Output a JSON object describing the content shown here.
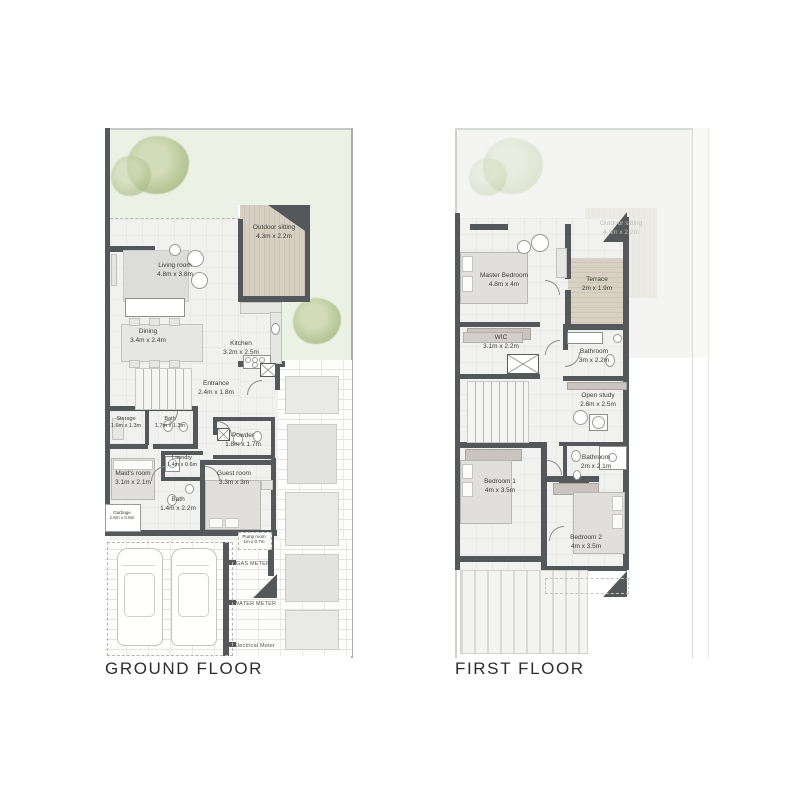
{
  "page": {
    "background": "#ffffff"
  },
  "colors": {
    "wall": "#54585a",
    "garden": "#ecf1e6",
    "deck": "#d1cabd",
    "floor": "#f1f1ef",
    "ghost": "#f4f4f2",
    "label_text": "#3c3c38",
    "tree": "#b2c48f"
  },
  "ground": {
    "title": "GROUND FLOOR",
    "rooms": {
      "outdoor": {
        "name": "Outdoor sitting",
        "dims": "4.3m x 2.2m"
      },
      "living": {
        "name": "Living room",
        "dims": "4.8m x 3.8m"
      },
      "dining": {
        "name": "Dining",
        "dims": "3.4m x 2.4m"
      },
      "kitchen": {
        "name": "Kitchen",
        "dims": "3.2m x 2.5m"
      },
      "entrance": {
        "name": "Entrance",
        "dims": "2.4m x 1.8m"
      },
      "storage": {
        "name": "Storage",
        "dims": "1.6m x 1.3m"
      },
      "bath": {
        "name": "Bath",
        "dims": "1.7m x 1.3m"
      },
      "powder": {
        "name": "Powder",
        "dims": "1.8m x 1.7m"
      },
      "laundry": {
        "name": "Laundry",
        "dims": "1.4m x 0.6m"
      },
      "maids": {
        "name": "Maid's room",
        "dims": "3.1m x 2.1m"
      },
      "guest": {
        "name": "Guest room",
        "dims": "3.3m x 3m"
      },
      "bath2": {
        "name": "Bath",
        "dims": "1.4m x 2.2m"
      },
      "garbage": {
        "name": "Garbage",
        "dims": "1.6m x 0.5m"
      },
      "pump": {
        "name": "Pump room",
        "dims": "1m x 0.7m"
      }
    },
    "utilities": {
      "gas": "GAS METER",
      "water": "WATER METER",
      "electrical": "Electrical Meter"
    }
  },
  "first": {
    "title": "FIRST FLOOR",
    "rooms": {
      "master": {
        "name": "Master Bedroom",
        "dims": "4.8m x 4m"
      },
      "terrace": {
        "name": "Terrace",
        "dims": "2m x 1.9m"
      },
      "outdoor_ghost": {
        "name": "Outdoor sitting",
        "dims": "4.3m x 2.2m"
      },
      "wic": {
        "name": "WIC",
        "dims": "3.1m x 2.2m"
      },
      "bathroom_m": {
        "name": "Bathroom",
        "dims": "3m x 2.2m"
      },
      "study": {
        "name": "Open study",
        "dims": "2.6m x 2.5m"
      },
      "bathroom2": {
        "name": "Bathroom",
        "dims": "2m x 2.1m"
      },
      "bedroom1": {
        "name": "Bedroom 1",
        "dims": "4m x 3.5m"
      },
      "bedroom2": {
        "name": "Bedroom 2",
        "dims": "4m x 3.5m"
      }
    }
  }
}
